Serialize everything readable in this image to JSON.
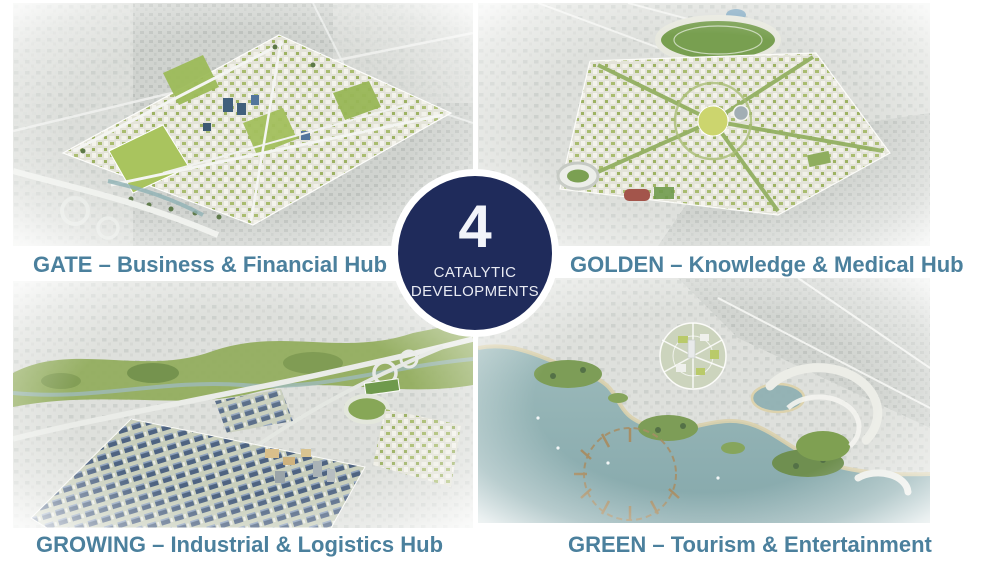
{
  "slide": {
    "badge": {
      "number": "4",
      "line1": "CATALYTIC",
      "line2": "DEVELOPMENTS"
    },
    "quadrants": [
      {
        "id": "gate",
        "caption": "GATE – Business & Financial Hub"
      },
      {
        "id": "golden",
        "caption": "GOLDEN – Knowledge & Medical Hub"
      },
      {
        "id": "growing",
        "caption": "GROWING – Industrial & Logistics Hub"
      },
      {
        "id": "green",
        "caption": "GREEN – Tourism & Entertainment"
      }
    ],
    "colors": {
      "badge_navy": "#1f2b5b",
      "badge_ring": "#ffffff",
      "caption_teal": "#4b809d",
      "background": "#ffffff"
    }
  }
}
